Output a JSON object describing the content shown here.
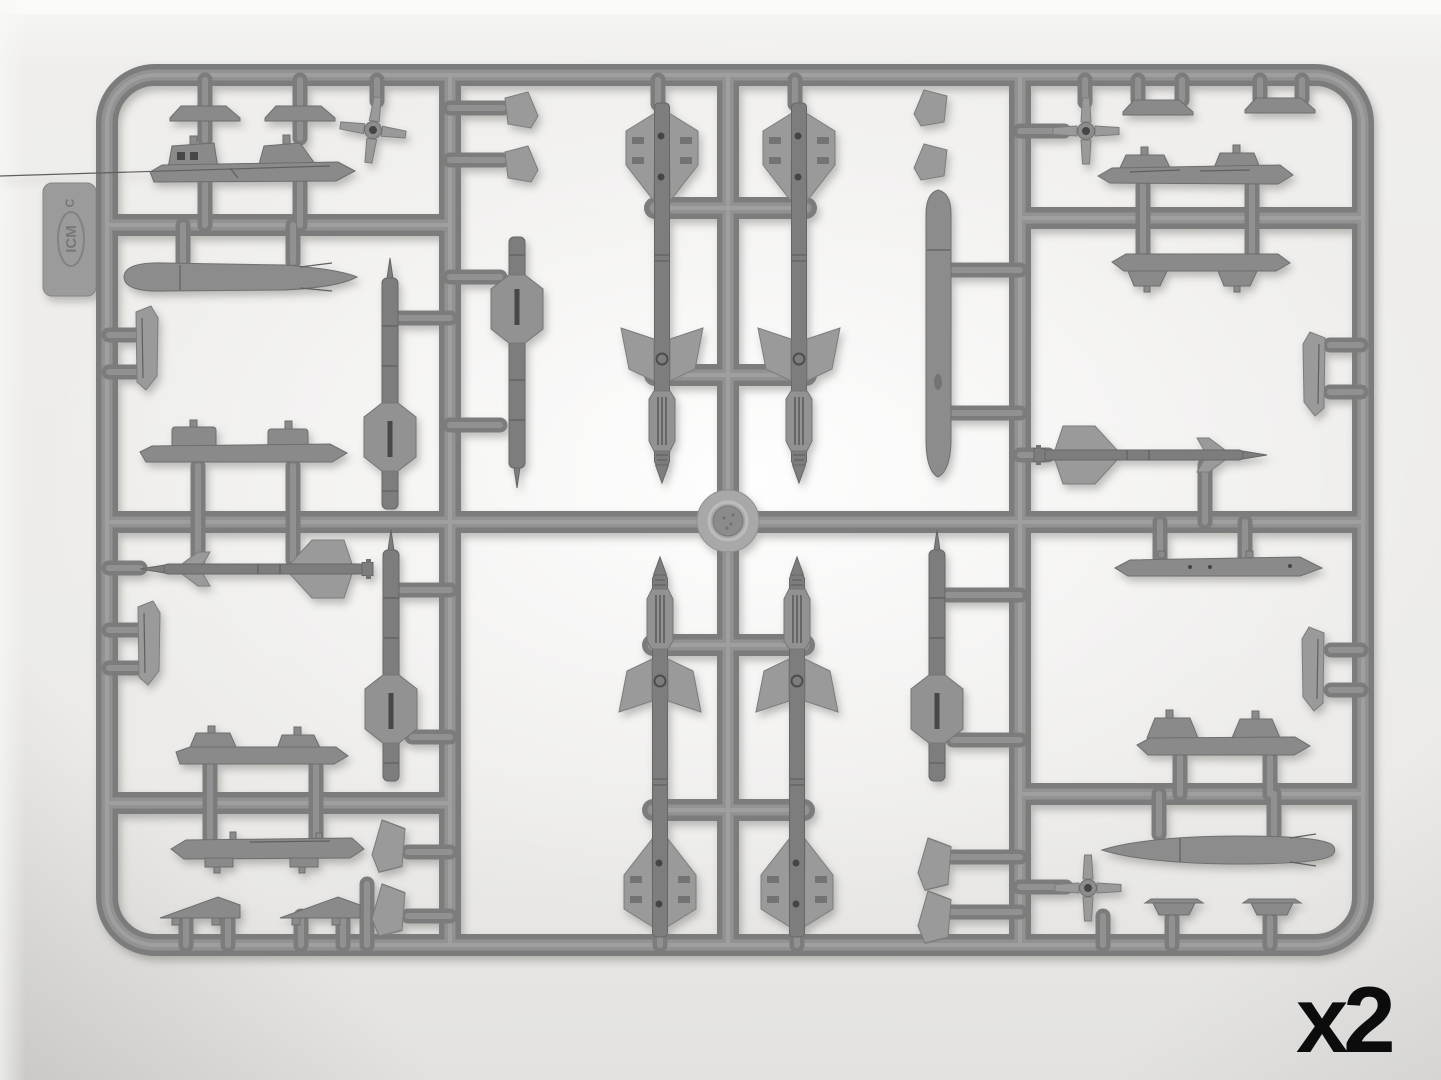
{
  "photo": {
    "subject": "Gray injection-molded model-kit sprue with aircraft armament parts (missiles, drop tanks, pylons, fins) photographed on a white lightbox",
    "quantity_label": "x2",
    "sprue_tab": {
      "brand": "ICM",
      "letter": "C"
    },
    "colors": {
      "background": "#edecea",
      "plastic_runner": "#868686",
      "plastic_part_dark": "#7d7d7d",
      "plastic_part_light": "#9a9a9a",
      "quantity_label_color": "#0c0c0c"
    },
    "parts_inventory": [
      {
        "part": "medium-range-missile-half-large-fins",
        "count": 4
      },
      {
        "part": "missile-body-half-with-backing-plate",
        "count": 4
      },
      {
        "part": "short-range-missile-half",
        "count": 2
      },
      {
        "part": "drop-tank-half",
        "count": 3
      },
      {
        "part": "pylon-or-launch-rail",
        "count": 8
      },
      {
        "part": "cruciform-fin-unit",
        "count": 3
      },
      {
        "part": "pylon-foot-wedge",
        "count": 6
      },
      {
        "part": "small-fin",
        "count": 12
      }
    ]
  }
}
